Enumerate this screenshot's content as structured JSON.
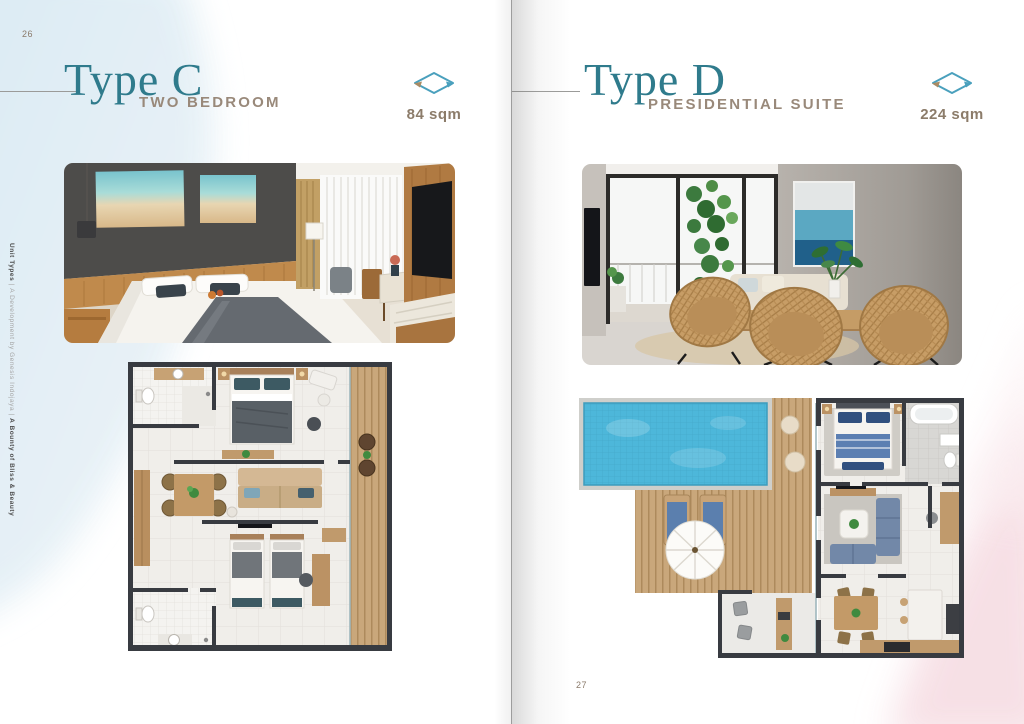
{
  "left_page": {
    "page_number": "26",
    "title": "Type C",
    "subtitle": "TWO BEDROOM",
    "area_label": "84 sqm",
    "area_icon": "area-dimension-icon"
  },
  "right_page": {
    "page_number": "27",
    "title": "Type D",
    "subtitle": "PRESIDENTIAL SUITE",
    "area_label": "224 sqm",
    "area_icon": "area-dimension-icon"
  },
  "sidebar": {
    "part_bold_1": "Unit Types",
    "separator_1": " | ",
    "part_light": "A Development by Genesis Indojaya",
    "separator_2": " | ",
    "part_bold_2": "A Bounty of Bliss & Beauty"
  },
  "colors": {
    "title_teal": "#2F7B8C",
    "subtitle_tan": "#99897A",
    "area_text_brown": "#8C7C6A",
    "icon_blue": "#4AA0BD",
    "icon_arrow_tan": "#A98B64",
    "background_blue_tint": "#DCEBF4",
    "background_pink_tint": "#F7DEE4",
    "floorplan_wall": "#383B41",
    "pool_water": "#4DB7DA"
  }
}
